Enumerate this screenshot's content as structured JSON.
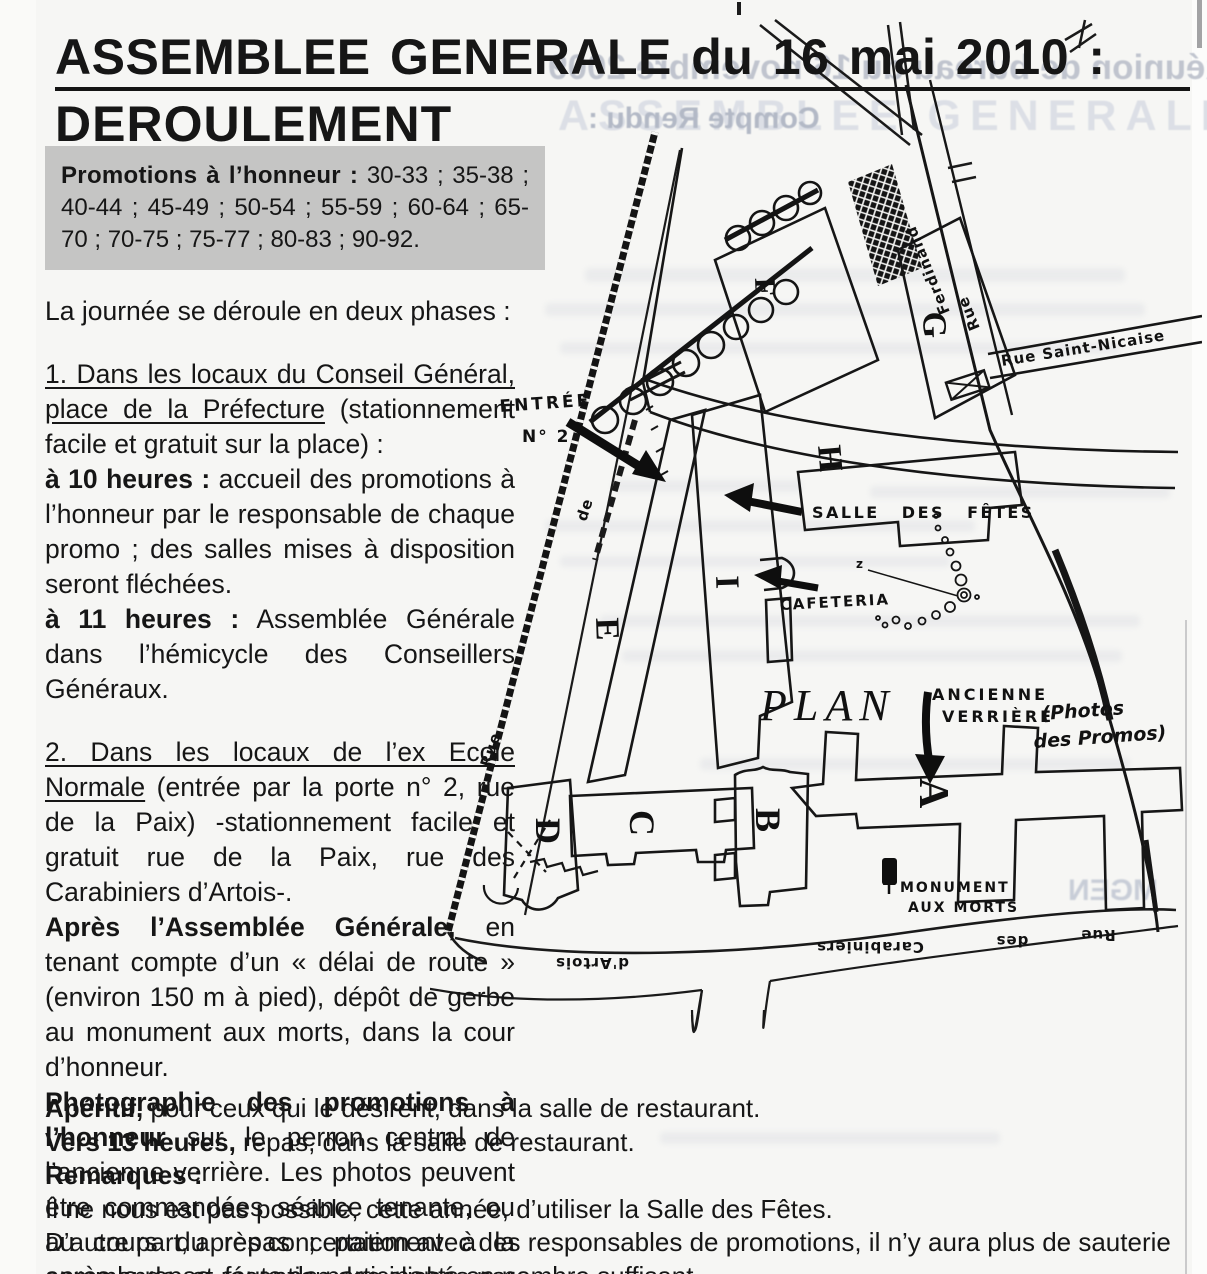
{
  "title": {
    "line1": "ASSEMBLEE GENERALE du 16 mai 2010 :",
    "line2": "DEROULEMENT"
  },
  "ghost": {
    "line1": "Réunion de bureau du 16 novembre 2009",
    "line2": "ASSEMBLEE GENERALE 2009",
    "line3": "Compte Rendu :",
    "mgen": "MGEN"
  },
  "promotions": {
    "label": "Promotions à l’honneur :",
    "values": " 30-33 ; 35-38 ; 40-44 ; 45-49 ; 50-54 ; 55-59 ; 60-64 ; 65-70 ;  70-75 ; 75-77 ; 80-83 ; 90-92."
  },
  "body": {
    "intro": "La journée se déroule en deux phases :",
    "p1_head": "1. Dans les locaux du Conseil Général, place de la Préfecture",
    "p1_rest": " (stationnement facile et gratuit sur la place) :",
    "p2_head": "à 10 heures :",
    "p2_rest": " accueil des promotions à l’honneur par le responsable de chaque promo ; des salles mises à disposition seront fléchées.",
    "p3_head": "à 11 heures :",
    "p3_rest": " Assemblée Générale dans l’hémicycle des Conseillers Généraux.",
    "p4_head": "2. Dans les locaux de l’ex Ecole Normale",
    "p4_rest": " (entrée par la porte n° 2, rue de la Paix) -stationnement facile et gratuit rue de la Paix, rue des Carabiniers d’Artois-.",
    "p5_head": "Après l’Assemblée Générale,",
    "p5_rest": " en tenant compte d’un « délai de route » (environ 150 m à pied), dépôt de gerbe au monument aux morts, dans la cour d’honneur.",
    "p6_head": "Photographie des promotions à l’honneur",
    "p6_rest": " sur le perron central de l’ancienne verrière. Les photos peuvent être commandées séance tenante, ou au cours du repas ; paiement à la commande, et réception des clichés par courrier début juillet."
  },
  "bottom": {
    "b1_head": "Apéritif,",
    "b1_rest": " pour ceux qui le désirent, dans la salle de restaurant.",
    "b2_head": "Vers 13 heures,",
    "b2_rest": " repas, dans la salle de restaurant.",
    "b3": "Remarques :",
    "b4": "Il ne nous est pas possible, cette année, d’utiliser la Salle des Fêtes.",
    "b5": "D’autre part, après concertation avec des responsables de promotions, il n’y aura plus de sauterie après le repas, faute de participants en nombre suffisant."
  },
  "map": {
    "entree_line1": "ENTRÉE",
    "entree_line2": "N° 2",
    "salle_label": "SALLE DES FÊTES",
    "cafeteria_label": "CAFETERIA",
    "plan_label": "PLAN",
    "verriere_line1": "ANCIENNE",
    "verriere_line2": "VERRIÈRE",
    "photos_line1": "(Photos",
    "photos_line2": "des Promos)",
    "monument_line1": "MONUMENT",
    "monument_line2": "AUX MORTS",
    "z_mark": "z",
    "letters": {
      "a": "A",
      "b": "B",
      "c": "C",
      "d": "D",
      "e": "E",
      "f": "F",
      "g": "G",
      "h": "H",
      "i": "I"
    },
    "streets": {
      "paix_rue": "Rue",
      "paix_de": "de",
      "ferdinand": "Ferdinand",
      "ferdinand_rue": "Rue",
      "saint_nicaise": "Rue Saint-Nicaise",
      "bottom_rue": "Rue",
      "bottom_des": "des",
      "bottom_carabiniers": "Carabiniers",
      "bottom_artois": "d'Artois"
    }
  }
}
